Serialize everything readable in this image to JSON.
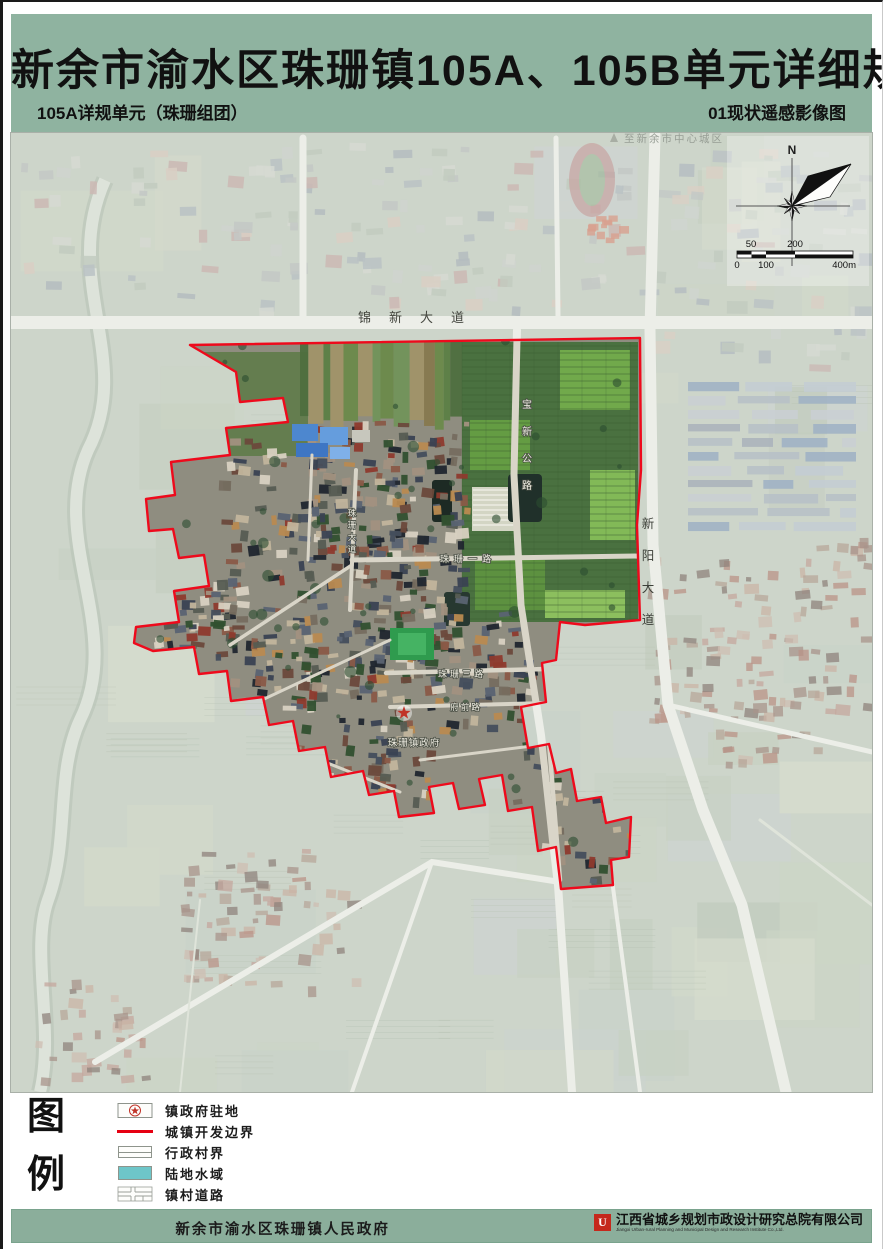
{
  "header": {
    "title": "新余市渝水区珠珊镇105A、105B单元详细规划",
    "subtitle_left": "105A详规单元（珠珊组团）",
    "subtitle_right": "01现状遥感影像图"
  },
  "map": {
    "annotation_to_city": "至新余市中心城区",
    "labels": {
      "road_jinxin": "锦新大道",
      "road_xinyang": "新阳大道",
      "road_baoxin": "宝新公路",
      "road_zhushan_avenue": "珠珊大道",
      "road_zhushan_yilu": "珠珊一路",
      "road_zhushan_sanlu": "珠珊三路",
      "road_fuqian": "府前路",
      "gov_seat": "珠珊镇政府"
    },
    "compass_north": "N",
    "scalebar": {
      "top": [
        "50",
        "200"
      ],
      "bottom": [
        "0",
        "100",
        "400m"
      ]
    },
    "boundary": "190,345 640,338 641,470 637,525 640,620 585,625 560,622 556,660 542,663 546,702 521,707 528,748 549,744 556,773 571,769 577,801 601,797 606,823 631,817 629,857 611,860 613,885 561,889 556,847 538,851 532,807 508,811 502,775 479,779 485,805 459,809 453,783 429,787 434,813 399,817 394,791 369,795 363,771 331,777 325,747 299,751 293,721 269,725 263,697 231,701 227,671 199,674 194,647 153,651 134,643 136,627 179,622 174,591 209,586 204,555 179,558 173,529 149,531 146,499 175,495 171,462 230,455 226,428 288,422 283,398 240,402 236,372 190,345"
  },
  "legend": {
    "chars": [
      "图",
      "例"
    ],
    "items": [
      {
        "label": "镇政府驻地"
      },
      {
        "label": "城镇开发边界"
      },
      {
        "label": "行政村界"
      },
      {
        "label": "陆地水域"
      },
      {
        "label": "镇村道路"
      }
    ]
  },
  "footer": {
    "government": "新余市渝水区珠珊镇人民政府",
    "company": "江西省城乡规划市政设计研究总院有限公司",
    "company_en": "Jiangxi Urban-rural Planning and Municipal Design and Research Institute Co.,Ltd."
  },
  "colors": {
    "header_green": "#8fb3a0",
    "footer_green": "#8bae9b",
    "boundary_red": "#ee0a1c",
    "water_teal": "#6ec6c9",
    "star_red": "#c03328"
  }
}
